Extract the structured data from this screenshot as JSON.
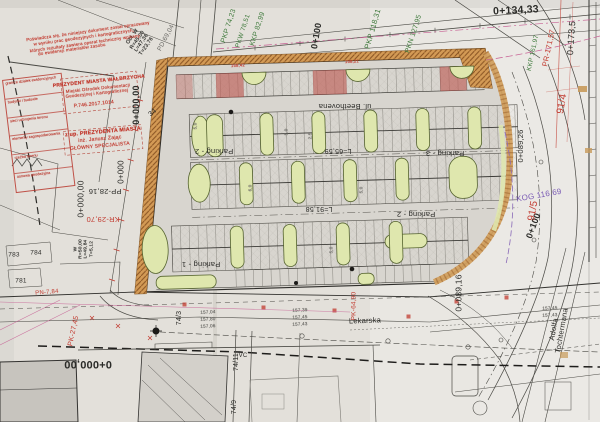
{
  "palette": {
    "paper": "#e3e0da",
    "ink": "#2b2b28",
    "gray": "#6b6a66",
    "green": "#3f7a3c",
    "red": "#c23b30",
    "purple": "#7a5bb5",
    "magenta": "#c75f93",
    "orange": "#d39a55",
    "island": "#dfe7ae",
    "asphalt": "#d8d5cf"
  },
  "stamps": {
    "table": {
      "rows": [
        "granice działek ewidencyjnych",
        "budynki i budowle",
        "sieci uzbrojenia terenu",
        "elementy zagospodarowania",
        "rzeźba terenu",
        "osnowa geodezyjna"
      ]
    }
  },
  "labels": [
    {
      "id": "pkp-74-23",
      "t": "PKP 74,23",
      "x": 229,
      "y": 26,
      "r": -72,
      "s": 7,
      "c": "green"
    },
    {
      "id": "pkw-78-51",
      "t": "PKW 78,51",
      "x": 243,
      "y": 31,
      "r": -72,
      "s": 6.5,
      "c": "green"
    },
    {
      "id": "kkp-82-99",
      "t": "KKP 82,99",
      "x": 258,
      "y": 29,
      "r": -72,
      "s": 7,
      "c": "green"
    },
    {
      "id": "ch-0-100-top",
      "t": "0+100",
      "x": 317,
      "y": 36,
      "r": -80,
      "s": 9,
      "c": "ink",
      "w": 600
    },
    {
      "id": "pkp-118-31",
      "t": "PKP 118,31",
      "x": 373,
      "y": 29,
      "r": -74,
      "s": 7.5,
      "c": "green"
    },
    {
      "id": "pkn-127-95",
      "t": "PKN 127,95",
      "x": 414,
      "y": 34,
      "r": -72,
      "s": 7,
      "c": "green"
    },
    {
      "id": "ch-0-134-33",
      "t": "0+134,33",
      "x": 516,
      "y": 11,
      "r": -3,
      "s": 10.5,
      "c": "ink",
      "w": 600
    },
    {
      "id": "ch-0-173-5",
      "t": "0+173,5",
      "x": 572,
      "y": 38,
      "r": -86,
      "s": 9,
      "c": "ink"
    },
    {
      "id": "pr-171-57",
      "t": "PR-171,57",
      "x": 549,
      "y": 48,
      "r": -78,
      "s": 7.5,
      "c": "red"
    },
    {
      "id": "kkp-161-97",
      "t": "KKP 161,97",
      "x": 533,
      "y": 53,
      "r": -78,
      "s": 6.5,
      "c": "green"
    },
    {
      "id": "pd-69-04",
      "t": "PD 69,04",
      "x": 166,
      "y": 38,
      "r": -62,
      "s": 6.5,
      "c": "gray"
    },
    {
      "id": "curve-table-w1",
      "t": "Obł. W\nR=45,00\nL=47,36\nT=23,76",
      "x": 140,
      "y": 42,
      "r": -55,
      "s": 5.2,
      "c": "ink"
    },
    {
      "id": "curve-table-w2",
      "t": "W\nR=50,00\nL=49,84\nT=5,12",
      "x": 84,
      "y": 249,
      "r": -90,
      "s": 4.8,
      "c": "ink"
    },
    {
      "id": "ch-0-000-00-a",
      "t": "0+000,00",
      "x": 137,
      "y": 105,
      "r": -90,
      "s": 9,
      "c": "ink",
      "w": 600
    },
    {
      "id": "ch-0-000-b",
      "t": "0+000",
      "x": 122,
      "y": 172,
      "r": -90,
      "s": 8,
      "c": "ink"
    },
    {
      "id": "ch-0-000-00-c",
      "t": "0+000,00",
      "x": 81,
      "y": 199,
      "r": -90,
      "s": 8.5,
      "c": "ink"
    },
    {
      "id": "ch-0-000-00-d",
      "t": "0+000,00",
      "x": 88,
      "y": 363,
      "r": 180,
      "s": 11,
      "c": "ink",
      "w": 600
    },
    {
      "id": "pp-28-16",
      "t": "PP-28,16",
      "x": 105,
      "y": 191,
      "r": 180,
      "s": 7.5,
      "c": "ink"
    },
    {
      "id": "kr-29-70",
      "t": "KR-29,70",
      "x": 103,
      "y": 219,
      "r": 180,
      "s": 7.5,
      "c": "red"
    },
    {
      "id": "pk-27-45",
      "t": "PK-27,45",
      "x": 74,
      "y": 331,
      "r": -78,
      "s": 7,
      "c": "red"
    },
    {
      "id": "pk-64-90",
      "t": "PK-64,90",
      "x": 354,
      "y": 306,
      "r": -90,
      "s": 6.5,
      "c": "red"
    },
    {
      "id": "ch-0-100-right",
      "t": "0+100",
      "x": 534,
      "y": 226,
      "r": -70,
      "s": 9,
      "c": "ink",
      "w": 600
    },
    {
      "id": "ch-0-089-16",
      "t": "0+089,16",
      "x": 459,
      "y": 293,
      "r": -90,
      "s": 8.5,
      "c": "ink"
    },
    {
      "id": "ch-0-089-26",
      "t": "0+089,26",
      "x": 521,
      "y": 146,
      "r": -90,
      "s": 7.5,
      "c": "ink"
    },
    {
      "id": "kog-116-69",
      "t": "KOG 116,69",
      "x": 539,
      "y": 196,
      "r": -10,
      "s": 8,
      "c": "purple"
    },
    {
      "id": "parcel-91-5",
      "t": "91/5",
      "x": 534,
      "y": 211,
      "r": -80,
      "s": 10,
      "c": "red"
    },
    {
      "id": "parcel-91-4",
      "t": "91/4",
      "x": 563,
      "y": 104,
      "r": -80,
      "s": 10,
      "c": "red"
    },
    {
      "id": "parcel-34",
      "t": "34",
      "x": 153,
      "y": 113,
      "r": -40,
      "s": 7,
      "c": "ink"
    },
    {
      "id": "parcel-74-3",
      "t": "74/3",
      "x": 180,
      "y": 318,
      "r": -90,
      "s": 7,
      "c": "ink"
    },
    {
      "id": "parcel-74-11",
      "t": "74/11",
      "x": 237,
      "y": 362,
      "r": -90,
      "s": 7,
      "c": "ink"
    },
    {
      "id": "parcel-74-9",
      "t": "74/9",
      "x": 235,
      "y": 407,
      "r": -90,
      "s": 7,
      "c": "ink"
    },
    {
      "id": "parcel-783",
      "t": "783",
      "x": 14,
      "y": 255,
      "r": 0,
      "s": 6.5,
      "c": "ink"
    },
    {
      "id": "parcel-784",
      "t": "784",
      "x": 36,
      "y": 253,
      "r": 0,
      "s": 6.5,
      "c": "ink"
    },
    {
      "id": "parcel-781",
      "t": "781",
      "x": 21,
      "y": 281,
      "r": 0,
      "s": 6.5,
      "c": "ink"
    },
    {
      "id": "pn-7-84",
      "t": "PN-7,84",
      "x": 47,
      "y": 293,
      "r": -5,
      "s": 6,
      "c": "red"
    },
    {
      "id": "street-beethovena",
      "t": "ul. Beethovena",
      "x": 345,
      "y": 106,
      "r": 180,
      "s": 7.5,
      "c": "ink"
    },
    {
      "id": "street-lekarska",
      "t": "Lekarska",
      "x": 365,
      "y": 321,
      "r": -2,
      "s": 7.5,
      "c": "ink"
    },
    {
      "id": "street-tochtermana",
      "t": "Adolfa Tochtermana",
      "x": 558,
      "y": 330,
      "r": -80,
      "s": 7.5,
      "c": "ink"
    },
    {
      "id": "parking-1",
      "t": "Parking - 1",
      "x": 201,
      "y": 264,
      "r": 180,
      "s": 7.5,
      "c": "ink"
    },
    {
      "id": "parking-2-a",
      "t": "Parking - 2",
      "x": 214,
      "y": 151,
      "r": 180,
      "s": 7.5,
      "c": "ink"
    },
    {
      "id": "parking-3",
      "t": "Parking - 3",
      "x": 445,
      "y": 153,
      "r": 180,
      "s": 7.5,
      "c": "ink"
    },
    {
      "id": "parking-2-b",
      "t": "Parking - 2",
      "x": 416,
      "y": 214,
      "r": 180,
      "s": 7.5,
      "c": "ink"
    },
    {
      "id": "dim-l-65-59",
      "t": "L=65,59",
      "x": 338,
      "y": 150,
      "r": 180,
      "s": 7,
      "c": "ink"
    },
    {
      "id": "dim-l-91-58",
      "t": "L=91,58",
      "x": 319,
      "y": 208,
      "r": 180,
      "s": 7,
      "c": "ink"
    },
    {
      "id": "spot-157-04",
      "t": "157,04",
      "x": 208,
      "y": 313,
      "r": -3,
      "s": 4.6,
      "c": "gray"
    },
    {
      "id": "spot-157-80",
      "t": "157,80",
      "x": 208,
      "y": 320,
      "r": -3,
      "s": 4.6,
      "c": "gray"
    },
    {
      "id": "spot-157-06",
      "t": "157,06",
      "x": 208,
      "y": 327,
      "r": -3,
      "s": 4.6,
      "c": "gray"
    },
    {
      "id": "spot-157-39",
      "t": "157,39",
      "x": 300,
      "y": 311,
      "r": -3,
      "s": 4.6,
      "c": "gray"
    },
    {
      "id": "spot-157-45",
      "t": "157,45",
      "x": 300,
      "y": 318,
      "r": -3,
      "s": 4.6,
      "c": "gray"
    },
    {
      "id": "spot-157-43",
      "t": "157,43",
      "x": 300,
      "y": 325,
      "r": -3,
      "s": 4.6,
      "c": "gray"
    },
    {
      "id": "spot-157-45-b",
      "t": "157,45",
      "x": 550,
      "y": 309,
      "r": -3,
      "s": 4.6,
      "c": "gray"
    },
    {
      "id": "spot-157-43-b",
      "t": "157,43",
      "x": 550,
      "y": 316,
      "r": -3,
      "s": 4.6,
      "c": "gray"
    },
    {
      "id": "note-5-0-a",
      "t": "5,0",
      "x": 196,
      "y": 126,
      "r": -90,
      "s": 4.5,
      "c": "gray"
    },
    {
      "id": "note-5-0-b",
      "t": "5,0",
      "x": 287,
      "y": 132,
      "r": -90,
      "s": 4.5,
      "c": "gray"
    },
    {
      "id": "note-2-5",
      "t": "2,5",
      "x": 311,
      "y": 136,
      "r": -90,
      "s": 4.5,
      "c": "gray"
    },
    {
      "id": "note-6-0",
      "t": "6,0",
      "x": 251,
      "y": 188,
      "r": -90,
      "s": 4.5,
      "c": "gray"
    },
    {
      "id": "note-5-0-c",
      "t": "5,0",
      "x": 362,
      "y": 190,
      "r": -90,
      "s": 4.5,
      "c": "gray"
    },
    {
      "id": "note-5-0-d",
      "t": "5,0",
      "x": 332,
      "y": 250,
      "r": -90,
      "s": 4.5,
      "c": "gray"
    },
    {
      "id": "note-158-42",
      "t": "158,42",
      "x": 238,
      "y": 66,
      "r": -3,
      "s": 4.2,
      "c": "red"
    },
    {
      "id": "note-158-21",
      "t": "158,21",
      "x": 352,
      "y": 62,
      "r": -3,
      "s": 4.2,
      "c": "red"
    },
    {
      "id": "vc-mark",
      "t": "VC",
      "x": 243,
      "y": 356,
      "r": 0,
      "s": 6,
      "c": "ink"
    },
    {
      "id": "stamp-cert-1",
      "t": "Poświadcza się, że niniejszy dokument został opracowany",
      "x": 88,
      "y": 32,
      "r": -8,
      "s": 4.4,
      "c": "red"
    },
    {
      "id": "stamp-cert-2",
      "t": "w wyniku prac geodezyjnych i kartograficznych,",
      "x": 84,
      "y": 38,
      "r": -8,
      "s": 4.4,
      "c": "red"
    },
    {
      "id": "stamp-cert-3",
      "t": "których rezultaty zawiera operat techniczny wpisany",
      "x": 85,
      "y": 44,
      "r": -8,
      "s": 4.4,
      "c": "red"
    },
    {
      "id": "stamp-cert-4",
      "t": "do ewidencji materiałów zasobu",
      "x": 72,
      "y": 50,
      "r": -8,
      "s": 4.4,
      "c": "red"
    },
    {
      "id": "stamp-office-1",
      "t": "PREZYDENT MIASTA WAŁBRZYCHA",
      "x": 99,
      "y": 82,
      "r": -6,
      "s": 5,
      "c": "red",
      "w": 700
    },
    {
      "id": "stamp-office-2",
      "t": "Miejski Ośrodek Dokumentacji",
      "x": 98,
      "y": 89,
      "r": -6,
      "s": 4.4,
      "c": "red"
    },
    {
      "id": "stamp-office-3",
      "t": "Geodezyjnej i Kartograficznej",
      "x": 97,
      "y": 94,
      "r": -6,
      "s": 4.4,
      "c": "red"
    },
    {
      "id": "stamp-office-4",
      "t": "P.746.2017.1014",
      "x": 94,
      "y": 105,
      "r": -6,
      "s": 5,
      "c": "red"
    },
    {
      "id": "stamp-sign-1",
      "t": "z up. PREZYDENTA MIASTA",
      "x": 103,
      "y": 133,
      "r": -5,
      "s": 5.4,
      "c": "red",
      "w": 700
    },
    {
      "id": "stamp-sign-2",
      "t": "inż. Janusz Zając",
      "x": 100,
      "y": 140,
      "r": -5,
      "s": 5.2,
      "c": "red"
    },
    {
      "id": "stamp-sign-3",
      "t": "GŁÓWNY SPECJALISTA",
      "x": 100,
      "y": 147,
      "r": -5,
      "s": 5,
      "c": "red"
    }
  ]
}
